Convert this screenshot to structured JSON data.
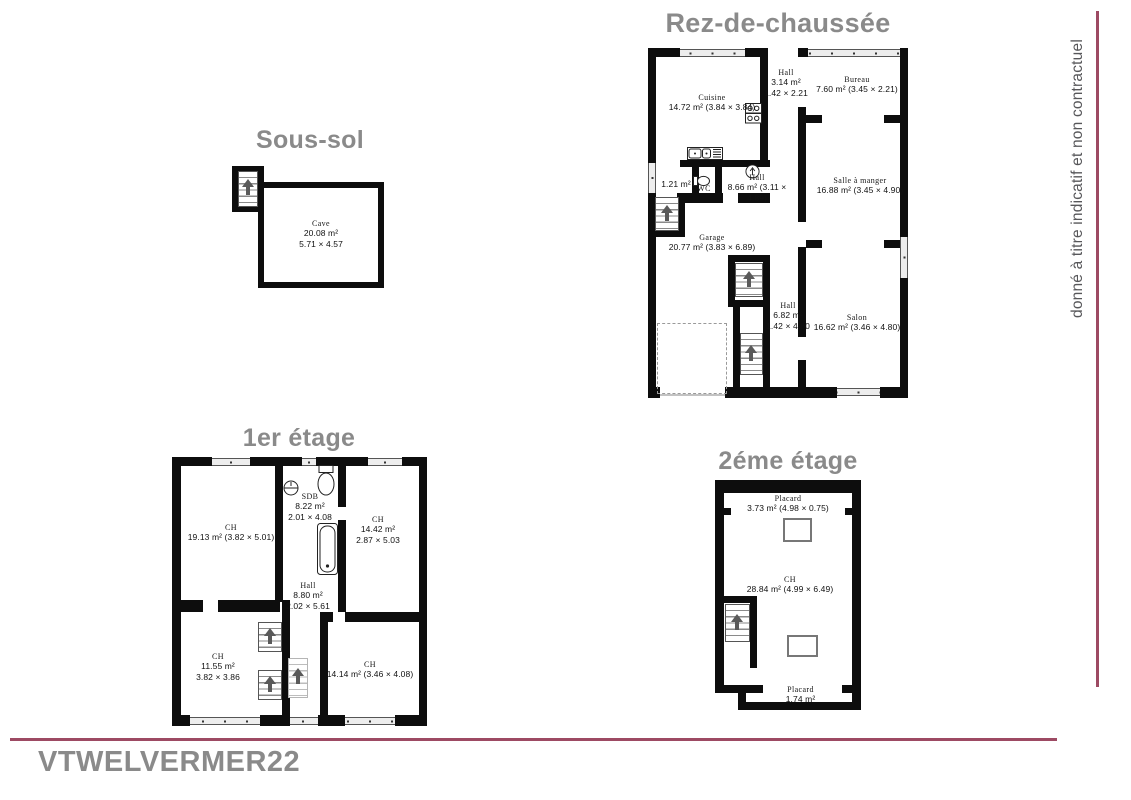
{
  "page": {
    "watermark": "VTWELVERMER22",
    "side_note": "donné à titre indicatif et non contractuel"
  },
  "colors": {
    "wall": "#0d0d0d",
    "title_gray": "#8a8a8a",
    "accent_line": "#9d4a63"
  },
  "floors": {
    "sous_sol": {
      "title": "Sous-sol",
      "rooms": {
        "cave": {
          "name": "Cave",
          "area": "20.08 m²",
          "dims": "5.71 × 4.57"
        }
      }
    },
    "rdc": {
      "title": "Rez-de-chaussée",
      "rooms": {
        "cuisine": {
          "name": "Cuisine",
          "area_dims": "14.72 m² (3.84 × 3.84)"
        },
        "hall_entree": {
          "name": "Hall",
          "area": "3.14 m²",
          "dims": "1.42 × 2.21"
        },
        "bureau": {
          "name": "Bureau",
          "area_dims": "7.60 m² (3.45 × 2.21)"
        },
        "wc": {
          "name": "WC",
          "area": "1.21 m²"
        },
        "hall": {
          "name": "Hall",
          "area_dims": "8.66 m² (3.11 × 4.89)"
        },
        "salle_a_manger": {
          "name": "Salle à manger",
          "area_dims": "16.88 m² (3.45 × 4.90)"
        },
        "garage": {
          "name": "Garage",
          "area_dims": "20.77 m² (3.83 × 6.89)"
        },
        "hall_bas": {
          "name": "Hall",
          "area": "6.82 m²",
          "dims": "1.42 × 4.80"
        },
        "salon": {
          "name": "Salon",
          "area_dims": "16.62 m² (3.46 × 4.80)"
        }
      }
    },
    "etage1": {
      "title": "1er étage",
      "rooms": {
        "ch_grande": {
          "name": "CH",
          "area_dims": "19.13 m² (3.82 × 5.01)"
        },
        "sdb": {
          "name": "SDB",
          "area": "8.22 m²",
          "dims": "2.01 × 4.08"
        },
        "ch_droite": {
          "name": "CH",
          "area": "14.42 m²",
          "dims": "2.87 × 5.03"
        },
        "hall": {
          "name": "Hall",
          "area": "8.80 m²",
          "dims": "2.02 × 5.61"
        },
        "ch_bas_gauche": {
          "name": "CH",
          "area": "11.55 m²",
          "dims": "3.82 × 3.86"
        },
        "ch_bas_droite": {
          "name": "CH",
          "area_dims": "14.14 m² (3.46 × 4.08)"
        }
      }
    },
    "etage2": {
      "title": "2éme étage",
      "rooms": {
        "placard_haut": {
          "name": "Placard",
          "area_dims": "3.73 m² (4.98 × 0.75)"
        },
        "ch": {
          "name": "CH",
          "area_dims": "28.84 m² (4.99 × 6.49)"
        },
        "placard_bas": {
          "name": "Placard",
          "area": "1.74 m²"
        }
      }
    }
  }
}
